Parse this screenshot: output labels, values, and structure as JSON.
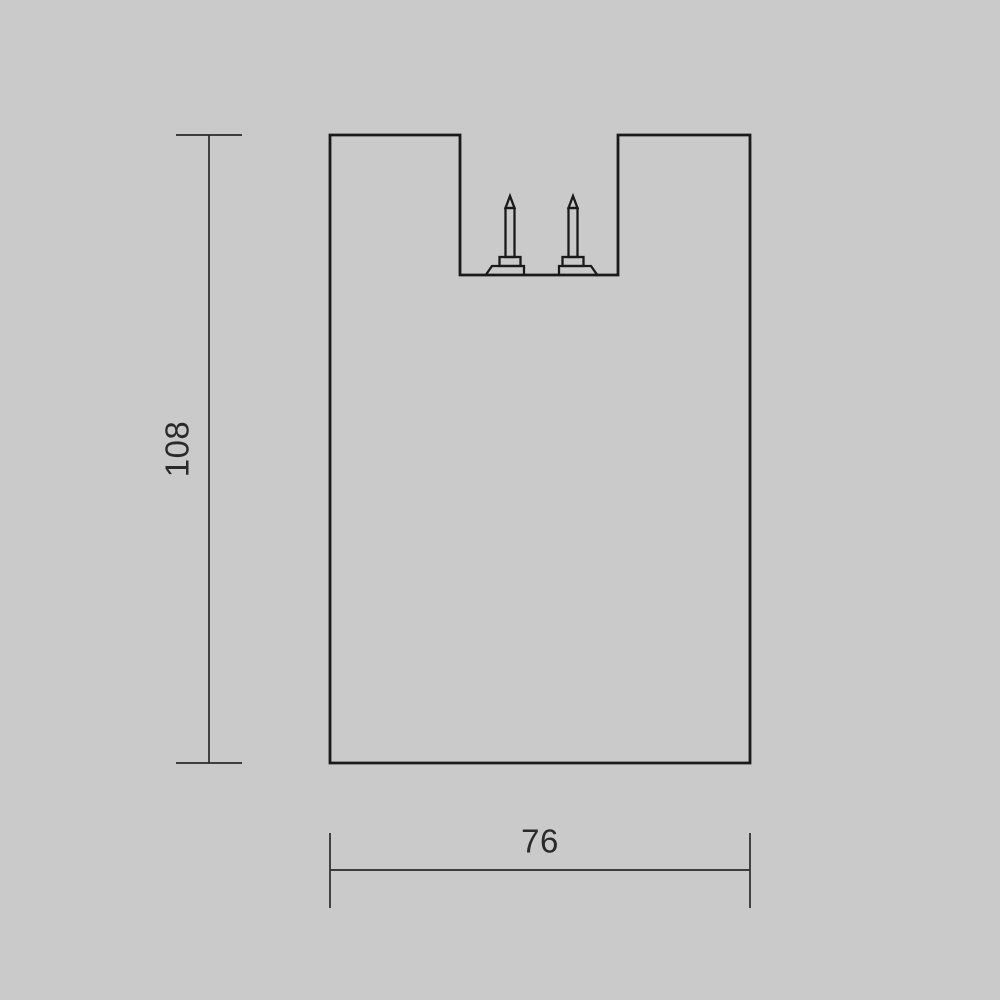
{
  "page": {
    "background_color": "#cacaca",
    "line_color": "#1a1a1a",
    "text_color": "#2a2a2a"
  },
  "drawing": {
    "description": "technical cross-section drawing of a fixture body with top recess and two contact pins",
    "dimensions": {
      "height": {
        "label": "108"
      },
      "width": {
        "label": "76"
      }
    }
  }
}
